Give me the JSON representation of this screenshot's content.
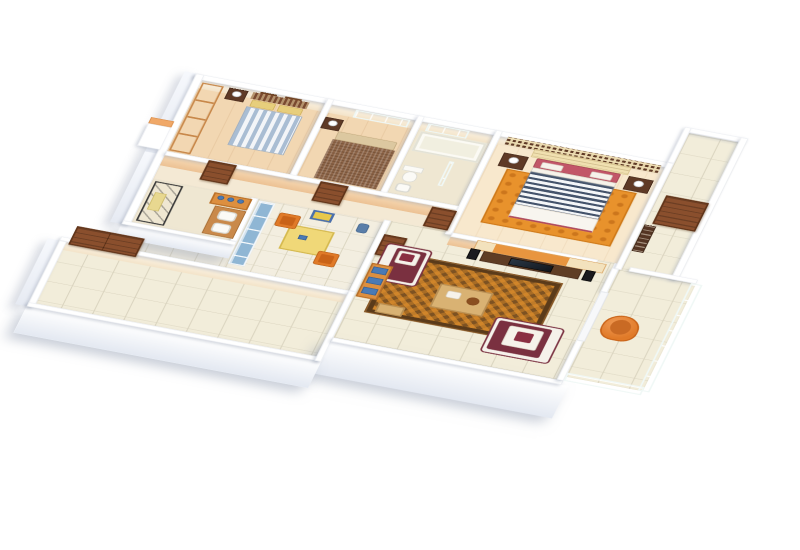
{
  "scene": {
    "kind": "3d-isometric-floor-plan-render",
    "background": "#ffffff",
    "view": "cutaway apartment seen from above at an angle, no text labels"
  },
  "palette": {
    "wall_top": "#ffffff",
    "wall_face_peach": "#f3cf9f",
    "wood_floor": "#f2d7b2",
    "master_wood_floor": "#f8e8cd",
    "tile_floor": "#f2edda",
    "tile_grout": "#d8d2bd",
    "teal_glass": "#b9e0d9",
    "door_brown": "#8a4f2d",
    "dark_wood": "#5f3a26",
    "orange_accent": "#e8913a",
    "maroon": "#7a3040",
    "navy_stripe": "#44536b",
    "blue_stripe": "#a9bdd3",
    "yellow_pillow": "#e7ce7c",
    "kitchen_blue": "#8fb6d4",
    "table_yellow": "#f0d878",
    "book_blue": "#4a7ab5"
  },
  "rooms": [
    {
      "id": "bedroom-1",
      "position": "top-left",
      "floor": "wood",
      "furniture": [
        "teal-glass-wardrobe",
        "striped-bed-blue-white",
        "yellow-pillows",
        "patterned-headboard",
        "nightstand-with-lamp",
        "two-wall-pictures"
      ]
    },
    {
      "id": "bedroom-2",
      "position": "top-center-left",
      "floor": "wood",
      "furniture": [
        "brown-textured-bed",
        "beige-pillows",
        "nightstand-with-lamp",
        "teal-window"
      ]
    },
    {
      "id": "bathroom-1",
      "position": "top-center",
      "floor": "stone",
      "furniture": [
        "bathtub",
        "toilet",
        "pedestal-sink",
        "teal-window",
        "glass-partition"
      ]
    },
    {
      "id": "master-bedroom",
      "position": "top-right",
      "floor": "light-wood",
      "furniture": [
        "dark-lattice-screen",
        "cream-tufted-headboard",
        "striped-bed-navy-white",
        "pink-pillows",
        "white-pillows",
        "two-nightstands-with-lamps",
        "orange-swirl-rug"
      ]
    },
    {
      "id": "entry-foyer",
      "position": "right",
      "floor": "tile",
      "furniture": [
        "brown-entry-door",
        "dark-slatted-rack",
        "top-right-alcove"
      ]
    },
    {
      "id": "balcony",
      "position": "right-lower",
      "floor": "tile",
      "furniture": [
        "teal-glass-railing",
        "orange-lounge-chair",
        "white-low-cabinet"
      ]
    },
    {
      "id": "living-room",
      "position": "center-bottom",
      "floor": "tile",
      "furniture": [
        "woven-brown-orange-rug",
        "white-maroon-sofa-1",
        "white-maroon-sofa-2",
        "coffee-table",
        "tv-console",
        "tv",
        "two-speakers",
        "orange-tv-panel",
        "orange-bookshelf-blue-books",
        "tan-bench"
      ]
    },
    {
      "id": "kitchen-dining",
      "position": "center-left",
      "floor": "small-tile",
      "furniture": [
        "blue-glass-cabinet",
        "yellow-dining-table",
        "two-orange-chairs",
        "blue-wall-picture",
        "blue-bin",
        "brown-door"
      ]
    },
    {
      "id": "shower-bathroom",
      "position": "left-middle",
      "floor": "stone",
      "furniture": [
        "glass-shower-dark-frame",
        "yellow-towel",
        "wood-vanity-counter",
        "two-white-sinks",
        "orange-shelf-blue-bottles"
      ]
    },
    {
      "id": "corridor",
      "position": "middle-band",
      "floor": "light",
      "furniture": [
        "brown-door-bedroom-1",
        "brown-door-bedroom-2",
        "brown-door-master",
        "brown-door-kitchen"
      ]
    },
    {
      "id": "terrace-porch",
      "position": "bottom-left",
      "floor": "tile",
      "furniture": [
        "brown-double-entry-door",
        "low-white-parapet-walls"
      ]
    }
  ]
}
